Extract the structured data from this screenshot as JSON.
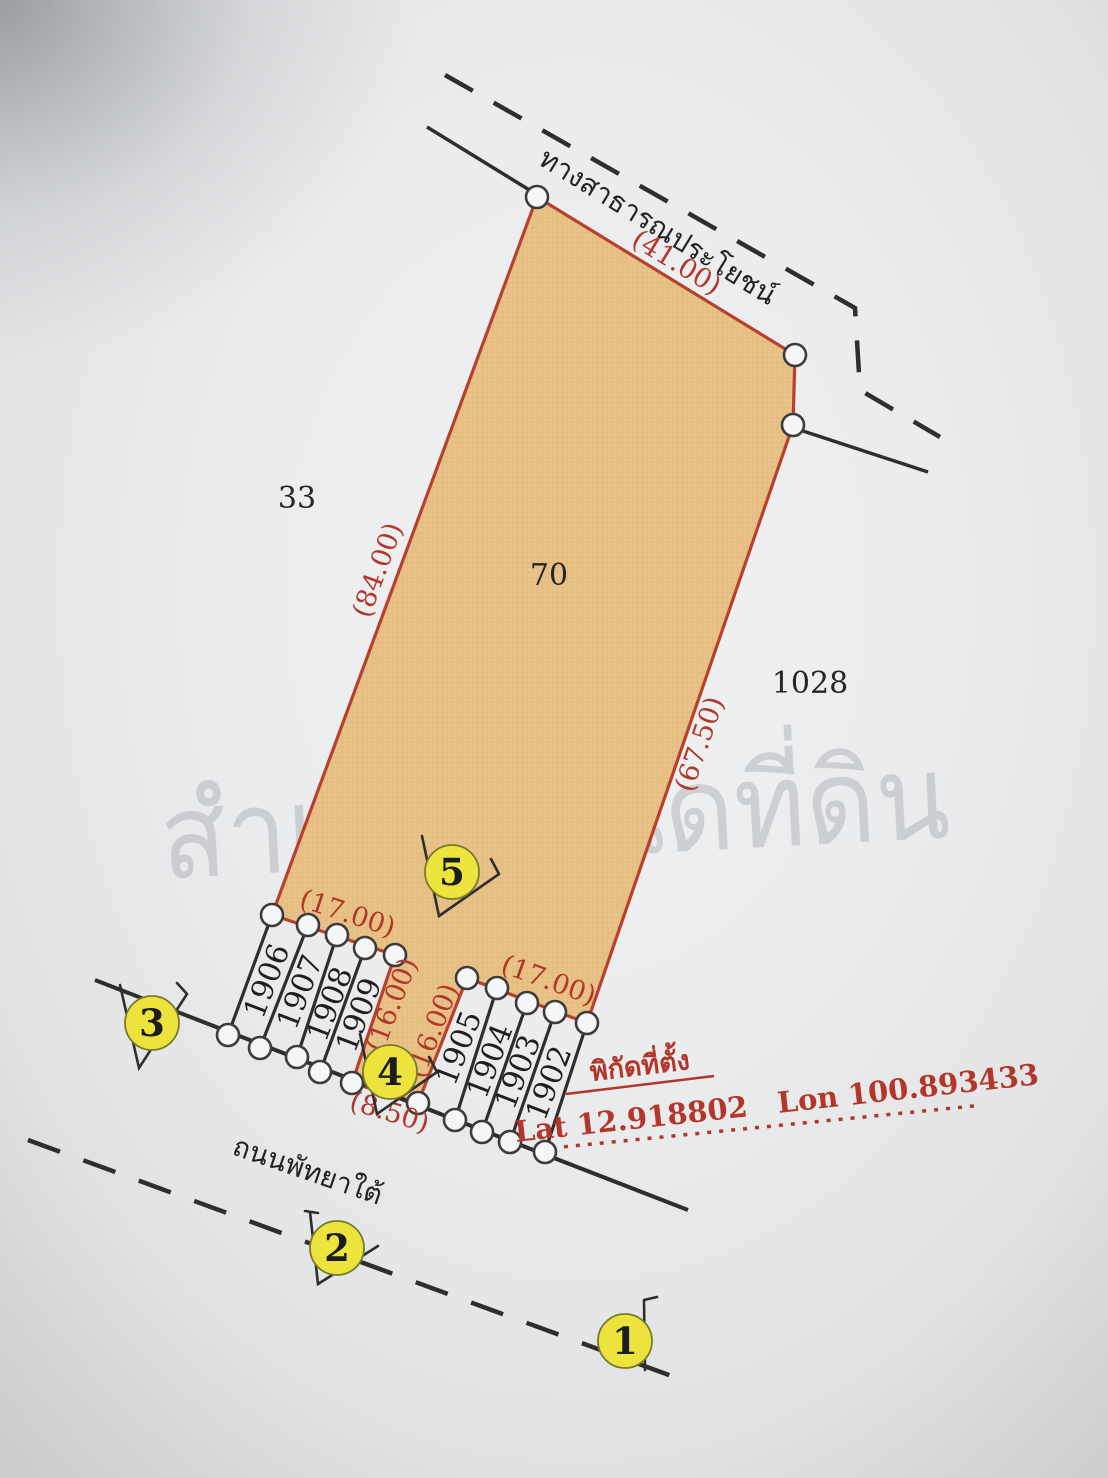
{
  "watermark": "สำเนาโฉนดที่ดิน",
  "roads": {
    "top_label": "ทางสาธารณประโยชน์",
    "bottom_label": "ถนนพัทยาใต้"
  },
  "parcels": {
    "main_number": "70",
    "neighbor_left": "33",
    "neighbor_right": "1028",
    "strip_left": [
      "1906",
      "1907",
      "1908",
      "1909"
    ],
    "strip_right": [
      "1905",
      "1904",
      "1903",
      "1902"
    ]
  },
  "dimensions": {
    "top_edge": "(41.00)",
    "left_edge": "(84.00)",
    "right_edge": "(67.50)",
    "strip_left_top": "(17.00)",
    "strip_right_top": "(17.00)",
    "notch_left": "(16.00)",
    "notch_right": "(16.00)",
    "notch_bottom": "(8.50)"
  },
  "markers": [
    "1",
    "2",
    "3",
    "4",
    "5"
  ],
  "location": {
    "heading": "พิกัดที่ตั้ง",
    "coordinates": "Lat 12.918802   Lon 100.893433"
  },
  "colors": {
    "paper": "#eaebed",
    "parcel_fill": "#e8c286",
    "parcel_border": "#b8402e",
    "dimension_text": "#b2372a",
    "marker_fill": "#ece33d",
    "line_black": "#2e2e2e"
  }
}
